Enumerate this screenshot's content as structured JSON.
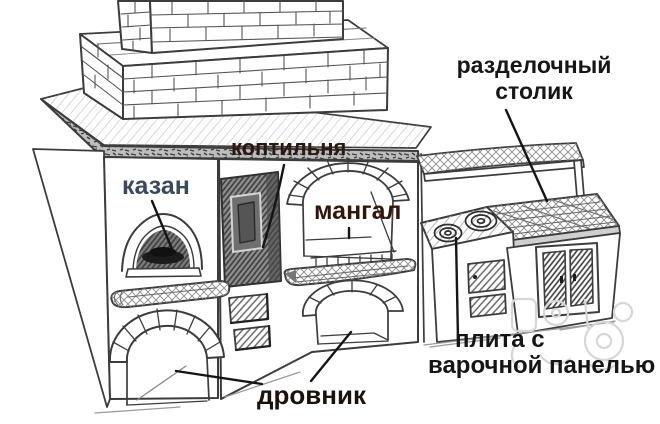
{
  "diagram": {
    "type": "hand-drawn-sketch",
    "subject": "brick outdoor stove complex",
    "background": "#ffffff",
    "stroke_color": "#3c3c3c",
    "labels": [
      {
        "id": "kazan",
        "text": "казан",
        "color": "#3b4a5a",
        "target": "kazan-oven-arch"
      },
      {
        "id": "koptilnya",
        "text": "коптильня",
        "color": "#2b1810",
        "target": "smokehouse-door"
      },
      {
        "id": "mangal",
        "text": "мангал",
        "color": "#331409",
        "target": "mangal-niche"
      },
      {
        "id": "razdelochny-stolik",
        "lines": [
          "разделочный",
          "столик"
        ],
        "color": "#161616",
        "target": "cutting-table"
      },
      {
        "id": "plita",
        "lines": [
          "плита с",
          "варочной панелью"
        ],
        "color": "#151515",
        "target": "stove-burners"
      },
      {
        "id": "drovnik",
        "text": "дровник",
        "color": "#1c120c",
        "target": "woodshed-arches"
      }
    ]
  }
}
